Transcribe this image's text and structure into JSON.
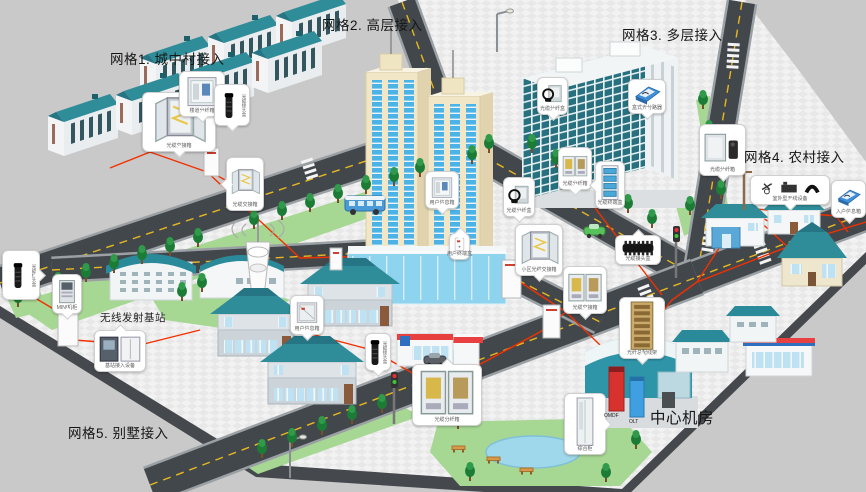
{
  "labels": {
    "grid1": "网格1. 城中村接入",
    "grid2": "网格2. 高层接入",
    "grid3": "网格3. 多层接入",
    "grid4": "网格4. 农村接入",
    "grid5": "网格5. 别墅接入",
    "central_room": "中心机房",
    "wireless_station": "无线发射基站",
    "omdf": "OMDF",
    "olt": "OLT"
  },
  "colors": {
    "background": "#c9c9c9",
    "fiber": "#f23000",
    "road": "#42474c",
    "lawn": "#a6d793",
    "roof_teal": "#2f8d99",
    "omdf_red": "#d8322e",
    "olt_blue": "#3f9fe0"
  },
  "callouts": [
    {
      "label": "光缆交接箱",
      "icon": "cabinet-open",
      "x": 142,
      "y": 92,
      "w": 74,
      "h": 60,
      "tail": "b"
    },
    {
      "label": "楼道分纤箱",
      "icon": "wallbox",
      "x": 179,
      "y": 71,
      "w": 46,
      "h": 46,
      "tail": "b"
    },
    {
      "label": "光缆接头盒",
      "icon": "closure-v",
      "x": 214,
      "y": 84,
      "w": 36,
      "h": 42,
      "tail": "b",
      "vert": true
    },
    {
      "label": "光缆交接箱",
      "icon": "cabinet-open",
      "x": 226,
      "y": 157,
      "w": 38,
      "h": 54,
      "tail": "l"
    },
    {
      "label": "光缆接头盒",
      "icon": "closure-v",
      "x": 2,
      "y": 250,
      "w": 38,
      "h": 50,
      "tail": "r",
      "vert": true
    },
    {
      "label": "MINI机柜",
      "icon": "mini",
      "x": 52,
      "y": 274,
      "w": 30,
      "h": 40,
      "tail": "b"
    },
    {
      "label": "基站接入设备",
      "icon": "base-eq",
      "x": 94,
      "y": 330,
      "w": 52,
      "h": 42,
      "tail": "t"
    },
    {
      "label": "用户信息箱",
      "icon": "wallbox-dk",
      "x": 290,
      "y": 295,
      "w": 34,
      "h": 40,
      "tail": "b"
    },
    {
      "label": "光缆接头盒",
      "icon": "closure-v",
      "x": 365,
      "y": 333,
      "w": 26,
      "h": 38,
      "tail": "b",
      "vert": true
    },
    {
      "label": "光缆分纤箱",
      "icon": "cabinet-two",
      "x": 412,
      "y": 364,
      "w": 70,
      "h": 62,
      "tail": "t"
    },
    {
      "label": "用户信息箱",
      "icon": "wallbox",
      "x": 425,
      "y": 171,
      "w": 34,
      "h": 38,
      "tail": "b"
    },
    {
      "label": "用户终端盒",
      "icon": "plate",
      "x": 449,
      "y": 233,
      "w": 21,
      "h": 27,
      "tail": "t"
    },
    {
      "label": "光缆分纤盒",
      "icon": "coil",
      "x": 503,
      "y": 177,
      "w": 32,
      "h": 40,
      "tail": "b"
    },
    {
      "label": "小区光缆交接箱",
      "icon": "cabinet-open",
      "x": 515,
      "y": 224,
      "w": 48,
      "h": 52,
      "tail": "b"
    },
    {
      "label": "光缆分纤箱",
      "icon": "cabinet-two",
      "x": 558,
      "y": 147,
      "w": 34,
      "h": 43,
      "tail": "b"
    },
    {
      "label": "光缆终端盒",
      "icon": "rack-blue",
      "x": 595,
      "y": 161,
      "w": 30,
      "h": 48,
      "tail": "l"
    },
    {
      "label": "光缆分纤盒",
      "icon": "coil",
      "x": 537,
      "y": 77,
      "w": 31,
      "h": 38,
      "tail": "b"
    },
    {
      "label": "盒式光分路器",
      "icon": "cassette",
      "x": 628,
      "y": 79,
      "w": 38,
      "h": 35,
      "tail": "b"
    },
    {
      "label": "光缆分纤箱",
      "icon": "cabinet-wall",
      "x": 699,
      "y": 124,
      "w": 47,
      "h": 52,
      "tail": "b"
    },
    {
      "label": "室外型无线设备",
      "icon": "devices3",
      "x": 750,
      "y": 175,
      "w": 80,
      "h": 30,
      "tail": "b"
    },
    {
      "label": "入户信息箱",
      "icon": "cassette",
      "x": 831,
      "y": 180,
      "w": 35,
      "h": 38,
      "tail": "b"
    },
    {
      "label": "光缆接头盒",
      "icon": "closure-f",
      "x": 615,
      "y": 235,
      "w": 46,
      "h": 30,
      "tail": "t"
    },
    {
      "label": "光缆交接箱",
      "icon": "cabinet-two",
      "x": 563,
      "y": 266,
      "w": 44,
      "h": 48,
      "tail": "b"
    },
    {
      "label": "光纤总配线架",
      "icon": "odf",
      "x": 619,
      "y": 297,
      "w": 46,
      "h": 62,
      "tail": "b"
    },
    {
      "label": "综合柜",
      "icon": "rack-white",
      "x": 564,
      "y": 393,
      "w": 42,
      "h": 62,
      "tail": "r"
    }
  ]
}
